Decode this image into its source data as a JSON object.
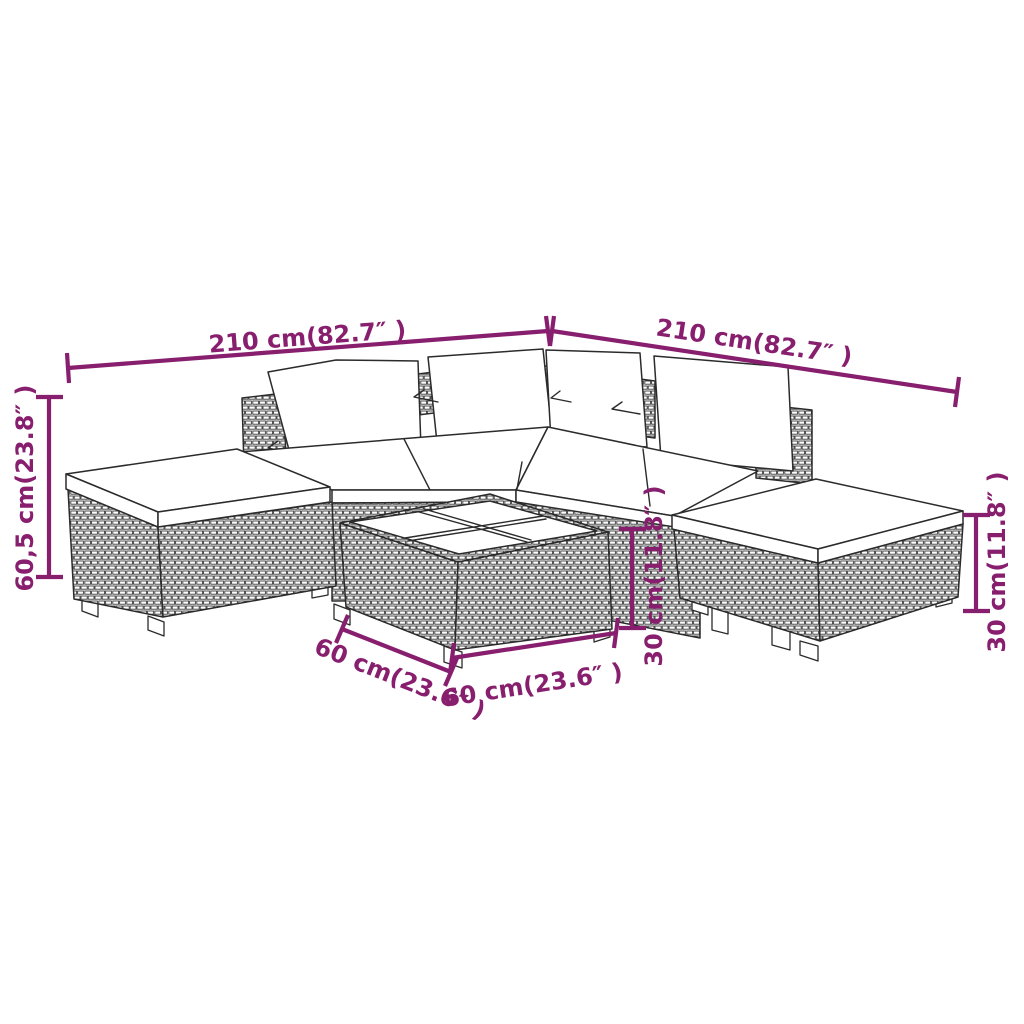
{
  "colors": {
    "dimension_accent": "#881e6e",
    "line": "#2b2b2b",
    "background": "#ffffff"
  },
  "dimensions": {
    "sofa_left_width": {
      "label": "210 cm(82.7″ )"
    },
    "sofa_right_width": {
      "label": "210 cm(82.7″ )"
    },
    "sofa_height": {
      "label": "60,5 cm(23.8″ )"
    },
    "table_height": {
      "label": "30 cm(11.8″ )"
    },
    "footstool_height": {
      "label": "30 cm(11.8″ )"
    },
    "table_depth": {
      "label": "60 cm(23.6″ )"
    },
    "table_width": {
      "label": "60 cm(23.6″ )"
    }
  }
}
